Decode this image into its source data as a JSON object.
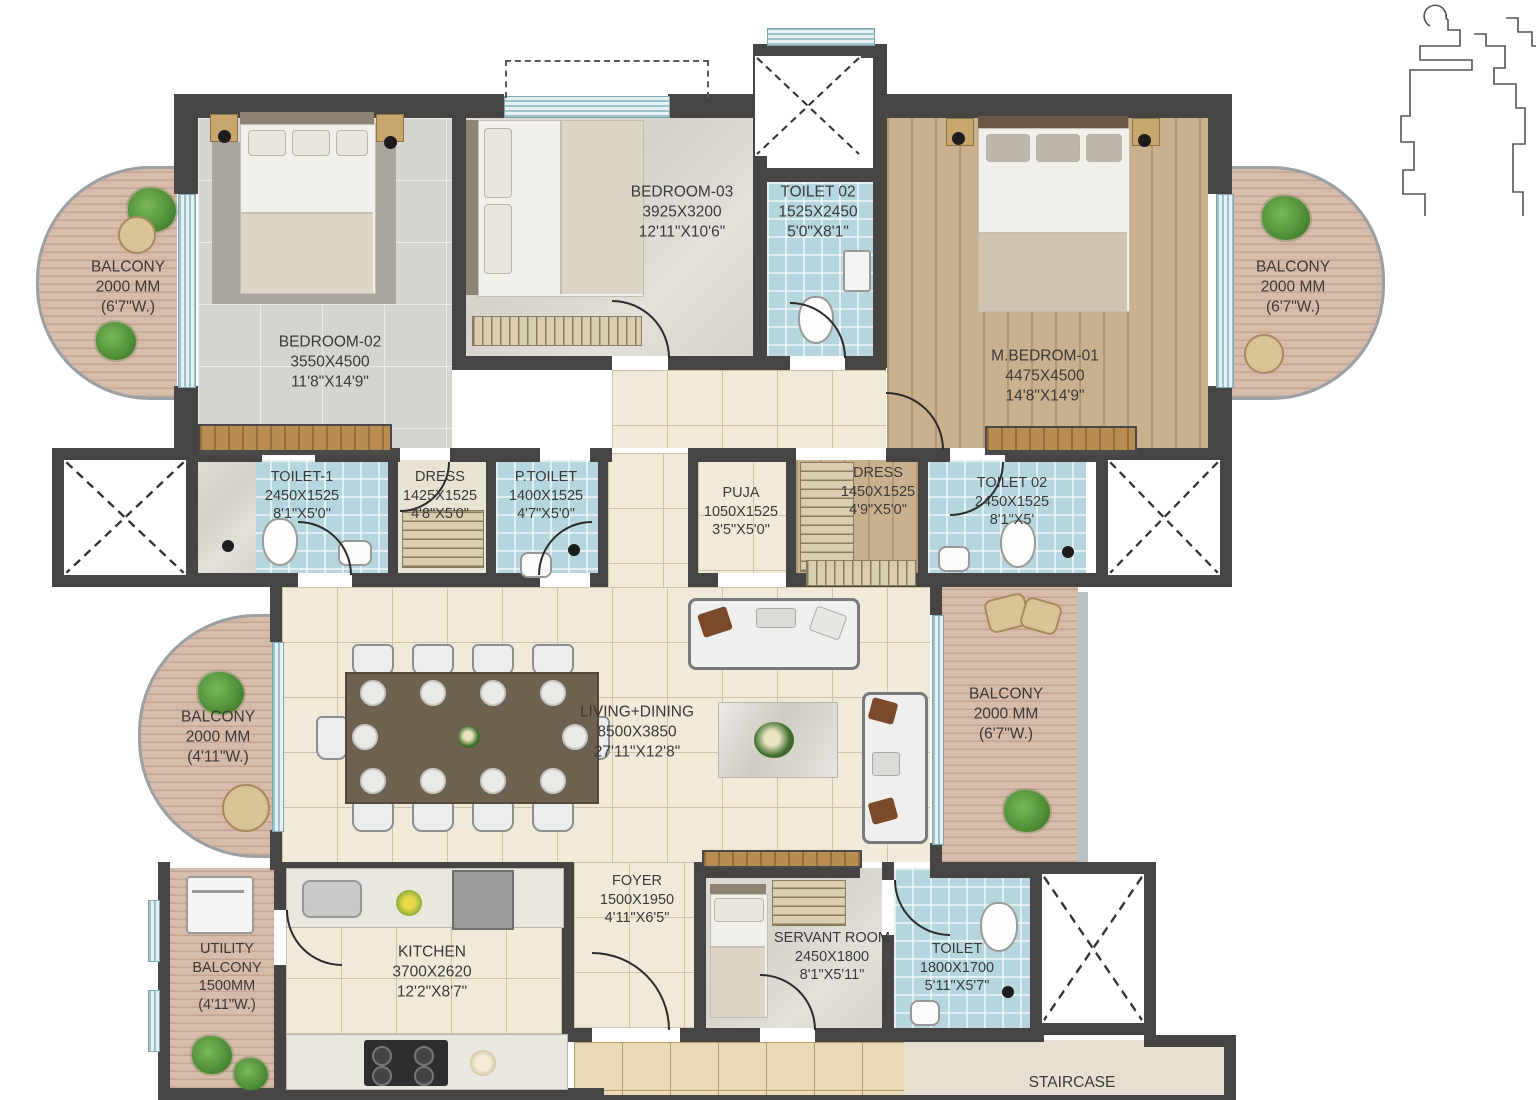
{
  "rooms": {
    "bedroom02": {
      "name": "BEDROOM-02",
      "dim_mm": "3550X4500",
      "dim_ft": "11'8\"X14'9\""
    },
    "bedroom03": {
      "name": "BEDROOM-03",
      "dim_mm": "3925X3200",
      "dim_ft": "12'11\"X10'6\""
    },
    "toilet02_top": {
      "name": "TOILET 02",
      "dim_mm": "1525X2450",
      "dim_ft": "5'0\"X8'1\""
    },
    "mbedroom01": {
      "name": "M.BEDROM-01",
      "dim_mm": "4475X4500",
      "dim_ft": "14'8\"X14'9\""
    },
    "balcony_tl": {
      "name": "BALCONY",
      "dim_mm": "2000 MM",
      "dim_ft": "(6'7\"W.)"
    },
    "balcony_tr": {
      "name": "BALCONY",
      "dim_mm": "2000 MM",
      "dim_ft": "(6'7\"W.)"
    },
    "toilet1": {
      "name": "TOILET-1",
      "dim_mm": "2450X1525",
      "dim_ft": "8'1\"X5'0\""
    },
    "dress_l": {
      "name": "DRESS",
      "dim_mm": "1425X1525",
      "dim_ft": "4'8\"X5'0\""
    },
    "ptoilet": {
      "name": "P.TOILET",
      "dim_mm": "1400X1525",
      "dim_ft": "4'7\"X5'0\""
    },
    "puja": {
      "name": "PUJA",
      "dim_mm": "1050X1525",
      "dim_ft": "3'5\"X5'0\""
    },
    "dress_r": {
      "name": "DRESS",
      "dim_mm": "1450X1525",
      "dim_ft": "4'9\"X5'0\""
    },
    "toilet02_r": {
      "name": "TOILET 02",
      "dim_mm": "2450X1525",
      "dim_ft": "8'1\"X5'"
    },
    "living": {
      "name": "LIVING+DINING",
      "dim_mm": "8500X3850",
      "dim_ft": "27'11\"X12'8\""
    },
    "balcony_ml": {
      "name": "BALCONY",
      "dim_mm": "2000 MM",
      "dim_ft": "(4'11\"W.)"
    },
    "balcony_mr": {
      "name": "BALCONY",
      "dim_mm": "2000 MM",
      "dim_ft": "(6'7\"W.)"
    },
    "utility": {
      "name": "UTILITY",
      "name2": "BALCONY",
      "dim_mm": "1500MM",
      "dim_ft": "(4'11\"W.)"
    },
    "kitchen": {
      "name": "KITCHEN",
      "dim_mm": "3700X2620",
      "dim_ft": "12'2\"X8'7\""
    },
    "foyer": {
      "name": "FOYER",
      "dim_mm": "1500X1950",
      "dim_ft": "4'11\"X6'5\""
    },
    "servant": {
      "name": "SERVANT ROOM",
      "dim_mm": "2450X1800",
      "dim_ft": "8'1\"X5'11\""
    },
    "toilet_b": {
      "name": "TOILET",
      "dim_mm": "1800X1700",
      "dim_ft": "5'11\"X5'7\""
    },
    "staircase": {
      "name": "STAIRCASE"
    }
  },
  "colors": {
    "wall": "#474544",
    "toilet_tile": "#b5d6de",
    "wood_floor": "#cab18e",
    "deck": "#d8bcab",
    "cream_tile": "#f2ead8",
    "window": "#cfe2e8"
  }
}
